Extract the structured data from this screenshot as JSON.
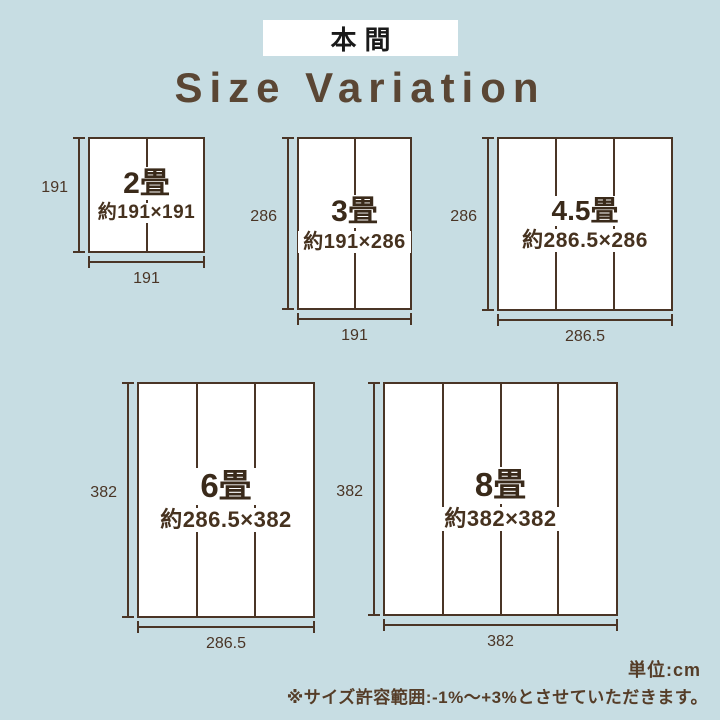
{
  "header": {
    "label": "本間"
  },
  "title": "Size Variation",
  "footer": {
    "unit": "単位:cm",
    "note": "※サイズ許容範囲:-1%〜+3%とさせていただきます。"
  },
  "colors": {
    "background": "#c7dde3",
    "line_brown": "#4a3526",
    "name_brown": "#3a2a1a",
    "title_brown": "#5a4634",
    "note_brown": "#553d28",
    "header_bg": "#ffffff",
    "header_text": "#1a1a1a",
    "box_fill": "#ffffff"
  },
  "sizes": [
    {
      "key": "s2",
      "name": "2畳",
      "dims": "約191×191",
      "height_label": "191",
      "width_label": "191",
      "mats": 2,
      "box": {
        "x": 88,
        "y": 137,
        "w": 117,
        "h": 116
      }
    },
    {
      "key": "s3",
      "name": "3畳",
      "dims": "約191×286",
      "height_label": "286",
      "width_label": "191",
      "mats": 2,
      "box": {
        "x": 297,
        "y": 137,
        "w": 115,
        "h": 173
      }
    },
    {
      "key": "s45",
      "name": "4.5畳",
      "dims": "約286.5×286",
      "height_label": "286",
      "width_label": "286.5",
      "mats": 3,
      "box": {
        "x": 497,
        "y": 137,
        "w": 176,
        "h": 174
      }
    },
    {
      "key": "s6",
      "name": "6畳",
      "dims": "約286.5×382",
      "height_label": "382",
      "width_label": "286.5",
      "mats": 3,
      "box": {
        "x": 137,
        "y": 382,
        "w": 178,
        "h": 236
      }
    },
    {
      "key": "s8",
      "name": "8畳",
      "dims": "約382×382",
      "height_label": "382",
      "width_label": "382",
      "mats": 4,
      "box": {
        "x": 383,
        "y": 382,
        "w": 235,
        "h": 234
      }
    }
  ]
}
